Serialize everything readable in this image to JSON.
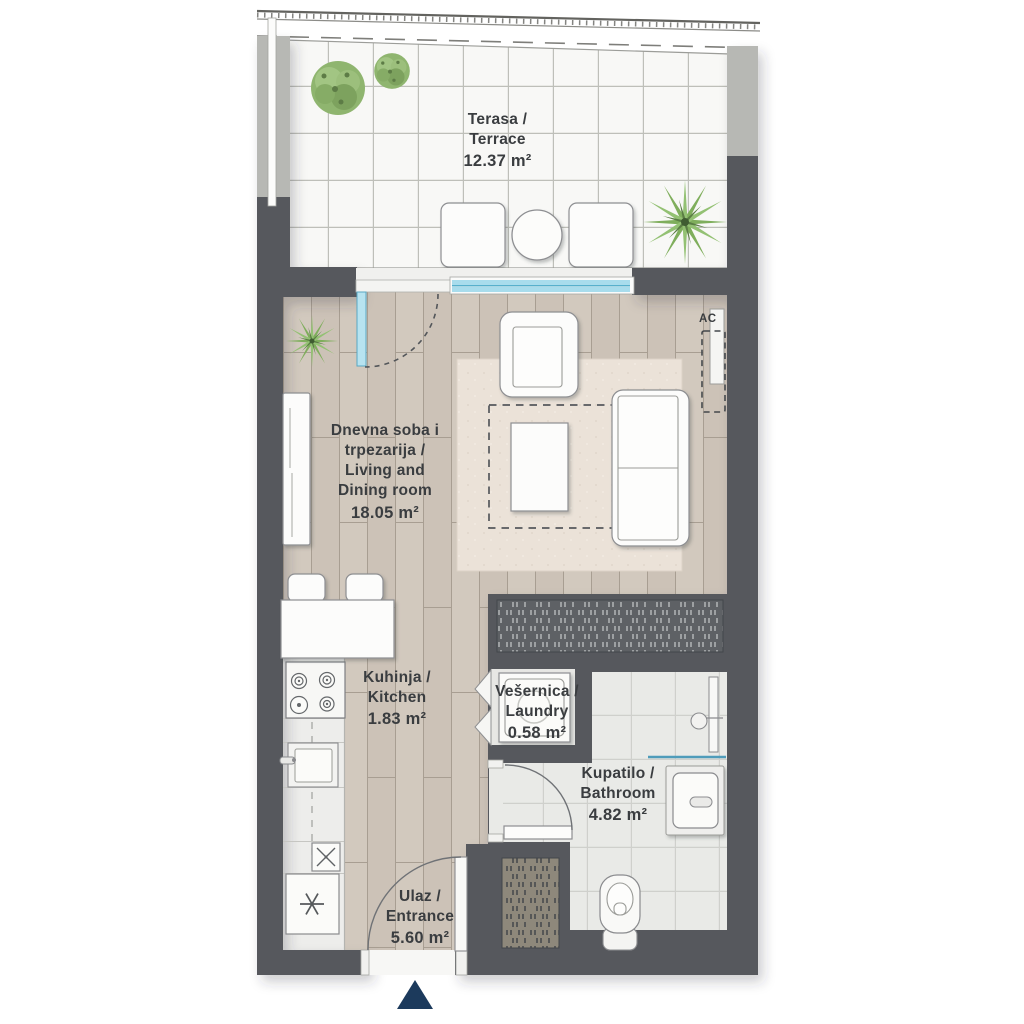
{
  "plan": {
    "rooms": {
      "terrace": {
        "lines": [
          "Terasa /",
          "Terrace"
        ],
        "area": "12.37 m²"
      },
      "living": {
        "lines": [
          "Dnevna soba i",
          "trpezarija /",
          "Living and",
          "Dining room"
        ],
        "area": "18.05 m²"
      },
      "kitchen": {
        "lines": [
          "Kuhinja /",
          "Kitchen"
        ],
        "area": "1.83 m²"
      },
      "laundry": {
        "lines": [
          "Vešernica /",
          "Laundry"
        ],
        "area": "0.58 m²"
      },
      "bathroom": {
        "lines": [
          "Kupatilo /",
          "Bathroom"
        ],
        "area": "4.82 m²"
      },
      "entrance": {
        "lines": [
          "Ulaz /",
          "Entrance"
        ],
        "area": "5.60 m²"
      }
    },
    "annotations": {
      "ac_unit": "AC"
    },
    "colors": {
      "wall_dark": "#56595d",
      "wall_pier_light": "#b7b8b4",
      "wood_floor": "#d0c7bc",
      "terrace_tile": "#f8f8f6",
      "bath_tile": "#e9eae7",
      "rug": "#ebe2d8",
      "glass": "#a8dcec",
      "plant_green": "#8fb56f",
      "entrance_arrow": "#1c3a5c",
      "label_text": "#3a3d40"
    }
  }
}
